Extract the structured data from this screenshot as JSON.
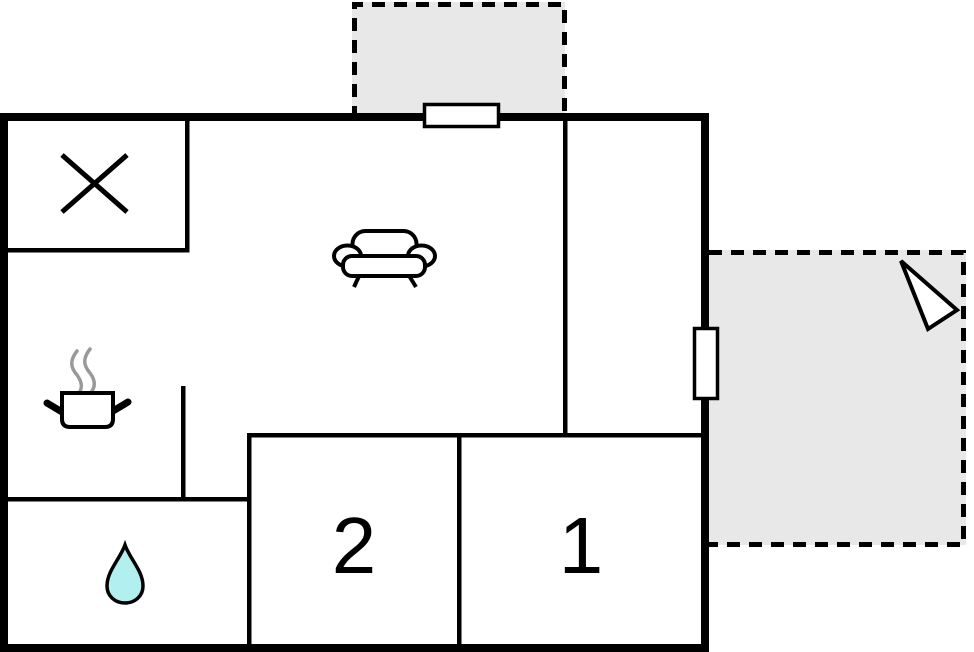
{
  "title": "Holiday home floor plan",
  "rooms": {
    "bedroom1": {
      "label": "1"
    },
    "bedroom2": {
      "label": "2"
    }
  },
  "icons": [
    "x-symbol-icon",
    "sofa-icon",
    "cooking-pot-icon",
    "steam-icon",
    "water-drop-icon",
    "entrance-arrow-icon",
    "window-top",
    "window-right"
  ],
  "colors": {
    "wall": "#000000",
    "terrace_fill": "#e8e8e8",
    "window_fill": "#ffffff",
    "water_drop": "#b2f0f0",
    "steam": "#999999",
    "arrow_fill": "#ffffff"
  }
}
